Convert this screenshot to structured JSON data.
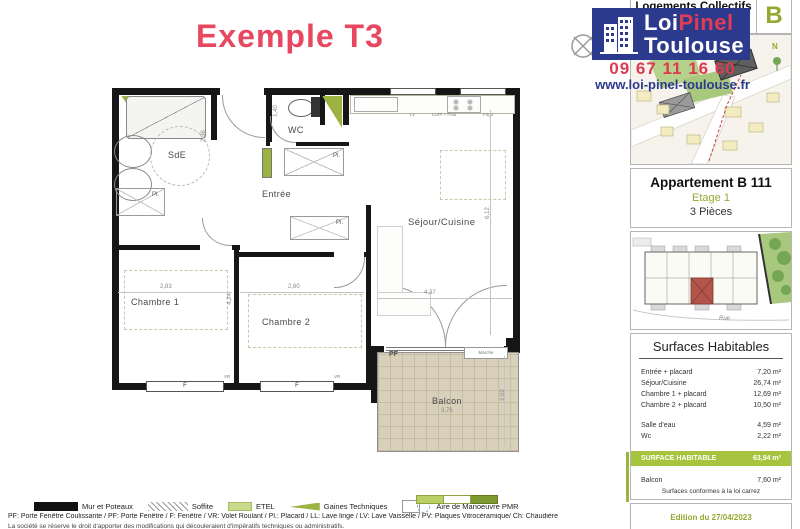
{
  "title": "Exemple T3",
  "header": {
    "collection": "Logements Collectifs",
    "building_letter": "B"
  },
  "logo": {
    "line1_white": "Loi",
    "line1_red": "Pinel",
    "line2": "Toulouse",
    "phone": "09 67 11 16 60",
    "website": "www.loi-pinel-toulouse.fr"
  },
  "apartment": {
    "name": "Appartement B 111",
    "floor": "Etage 1",
    "rooms": "3 Pièces"
  },
  "site_plan": {
    "north": "N"
  },
  "building_plan": {
    "street": "Rue",
    "units_top": [
      {
        "label": "B-102"
      },
      {
        "label": "B-103"
      },
      {
        "label": "B-104"
      },
      {
        "label": "B-105"
      },
      {
        "label": "B-107"
      }
    ],
    "units_bottom": [
      {
        "label": "B-109"
      },
      {
        "label": "B-101"
      },
      {
        "label": "B-111"
      },
      {
        "label": "B-110"
      }
    ]
  },
  "floor_plan": {
    "rooms": {
      "sde": "SdE",
      "wc": "WC",
      "entree": "Entrée",
      "sejour": "Séjour/Cuisine",
      "chambre1": "Chambre 1",
      "chambre2": "Chambre 2",
      "balcon": "Balcon"
    },
    "labels": {
      "pf": "PF",
      "marche": "Marche",
      "f1": "F",
      "f2": "F",
      "vr1": "VR",
      "vr2": "VR",
      "pl1": "Pl.",
      "pl2": "Pl.",
      "pl3": "Pl.",
      "lv": "Lv",
      "four": "LL/Pl + Four",
      "frigo": "Frigo"
    },
    "dims": {
      "chambre1_width": "2,83",
      "chambre2_width": "2,60",
      "sejour_width": "4,37",
      "sejour_height": "6,12",
      "balcon_width": "3,76",
      "balcon_height": "2,02",
      "chambre_height": "4,24",
      "wc_height": "1,40",
      "sde_width": "2,36"
    }
  },
  "surfaces": {
    "heading": "Surfaces Habitables",
    "rows": [
      {
        "label": "Entrée + placard",
        "value": "7,20 m²"
      },
      {
        "label": "Séjour/Cuisine",
        "value": "26,74 m²"
      },
      {
        "label": "Chambre 1 + placard",
        "value": "12,69 m²"
      },
      {
        "label": "Chambre 2 + placard",
        "value": "10,50 m²"
      },
      {
        "label": "Salle d'eau",
        "value": "4,59 m²",
        "gap_before": true
      },
      {
        "label": "Wc",
        "value": "2,22 m²"
      },
      {
        "label": "SURFACE HABITABLE",
        "value": "63,94 m²",
        "highlight": true,
        "gap_before": true
      },
      {
        "label": "Balcon",
        "value": "7,60 m²",
        "gap_before": true
      }
    ],
    "note": "Surfaces conformes à la loi carrez"
  },
  "edition": "Edition du 27/04/2023",
  "legend": {
    "items": [
      {
        "icon": "wall-swatch",
        "label": "Mur et Poteaux"
      },
      {
        "icon": "soffite-swatch",
        "label": "Soffite"
      },
      {
        "icon": "etel-swatch",
        "label": "ETEL"
      },
      {
        "icon": "gaines-swatch",
        "label": "Gaines Techniques"
      },
      {
        "icon": "pmr-swatch",
        "label": "Aire de Manoeuvre PMR"
      }
    ],
    "abbreviations": "PF: Porte Fenêtre Coulissante / PF: Porte Fenêtre / F: Fenêtre / VR: Volet Roulant / Pl.: Placard / LL: Lave linge / LV: Lave Vaisselle / PV: Plaques Vitrocéramique/ Ch: Chaudière",
    "disclaimer": "La société se réserve le droit d'apporter des modifications qui découleraient d'impératifs techniques ou administratifs."
  },
  "colors": {
    "accent_green": "#97a832",
    "highlight_green": "#a6c43d",
    "brand_blue": "#2b3a8c",
    "brand_red": "#dc3a50",
    "title_pink": "#e8485f"
  }
}
